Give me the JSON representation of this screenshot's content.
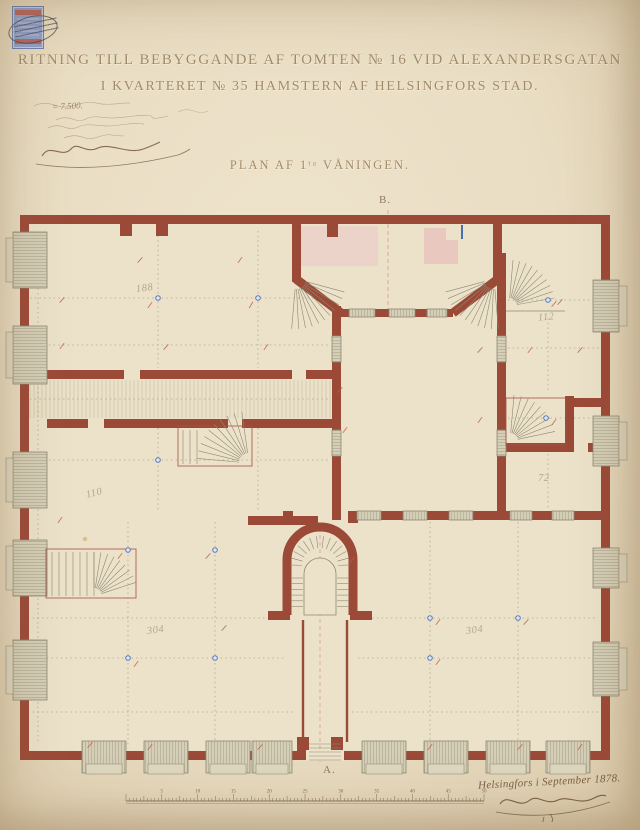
{
  "header": {
    "title_line1": "RITNING TILL BEBYGGANDE AF TOMTEN № 16 VID ALEXANDERSGATAN",
    "title_line2": "I KVARTERET № 35 HAMSTERN AF HELSINGFORS STAD.",
    "subtitle": "PLAN AF 1ᵗᵃ VÅNINGEN.",
    "note_fragment": "= 7.500."
  },
  "stamp": {
    "label": "revenue-stamp"
  },
  "plan": {
    "label_top": "B.",
    "label_bottom": "A.",
    "room_numbers": [
      {
        "value": "188",
        "x": 136,
        "y": 283,
        "rot": -8
      },
      {
        "value": "112",
        "x": 538,
        "y": 312,
        "rot": -5
      },
      {
        "value": "110",
        "x": 86,
        "y": 488,
        "rot": -14
      },
      {
        "value": "72",
        "x": 538,
        "y": 473,
        "rot": 0
      },
      {
        "value": "304",
        "x": 147,
        "y": 625,
        "rot": -8
      },
      {
        "value": "304",
        "x": 466,
        "y": 625,
        "rot": -8
      }
    ],
    "colors": {
      "wall": "#9c4a38",
      "window": "#d5cfb8",
      "windowline": "#a39d85",
      "pink": "#ecd0c9",
      "pink2": "#e9c4bd",
      "olive": "#9a9175",
      "red": "#c25847",
      "blue": "#5b79b8",
      "thin": "#8d8872",
      "paper": "#ece2ca",
      "ink": "#8f7a60"
    }
  },
  "footer": {
    "date": "Helsingfors i September 1878.",
    "scale_numbers": [
      "5",
      "10",
      "15",
      "20",
      "25",
      "30",
      "35",
      "40",
      "45",
      "50"
    ]
  }
}
